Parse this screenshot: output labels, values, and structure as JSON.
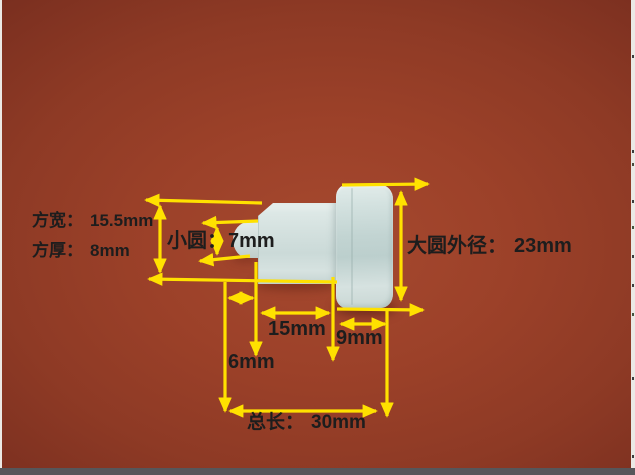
{
  "image_type": "annotated product dimension photo",
  "annotations": {
    "square_width": {
      "label": "方宽：",
      "value": "15.5mm",
      "value_mm": 15.5
    },
    "square_thickness": {
      "label": "方厚：",
      "value": "8mm",
      "value_mm": 8
    },
    "small_circle": {
      "label": "小圆：",
      "value": "7mm",
      "value_mm": 7
    },
    "large_circle_outer_diameter": {
      "label": "大圆外径：",
      "value": "23mm",
      "value_mm": 23
    },
    "flange_length": {
      "value": "15mm",
      "value_mm": 15
    },
    "disc_thickness": {
      "value": "9mm",
      "value_mm": 9
    },
    "stud_length": {
      "value": "6mm",
      "value_mm": 6
    },
    "total_length": {
      "label": "总长：",
      "value": "30mm",
      "value_mm": 30
    }
  },
  "colors": {
    "arrow_yellow": "#ffe100",
    "label_text": "#1d1d1d",
    "bg_center": "#a6492f",
    "bg_edge": "#6b2517",
    "part_body": "#cdddda",
    "bottom_bar": "#56565a",
    "edge_strip": "#ebe9e5"
  }
}
